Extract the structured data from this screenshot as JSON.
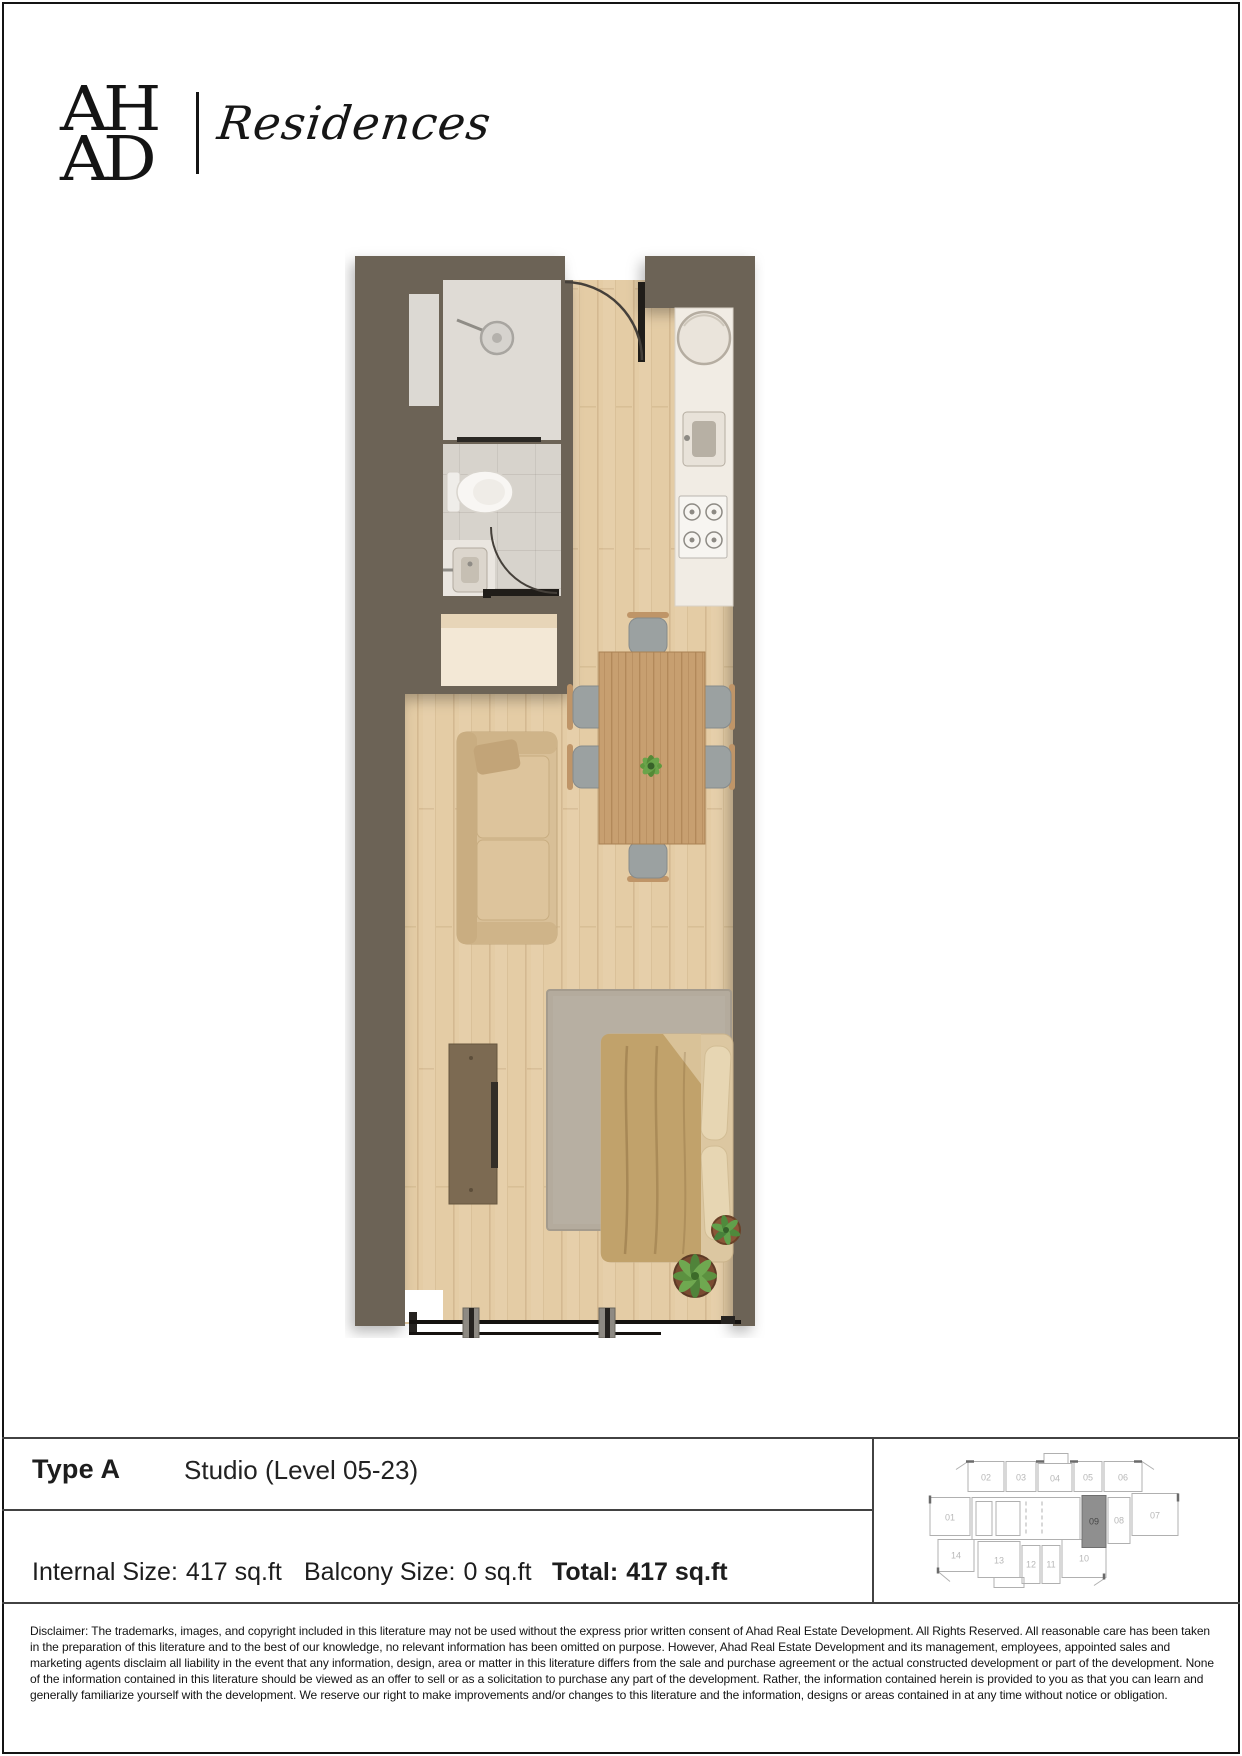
{
  "brand": {
    "logo_top": "AH",
    "logo_bottom": "AD",
    "wordmark": "Residences"
  },
  "unit": {
    "type_label": "Type A",
    "type_desc": "Studio (Level 05-23)",
    "internal_label": "Internal Size:",
    "internal_value": "417 sq.ft",
    "balcony_label": "Balcony Size:",
    "balcony_value": "0 sq.ft",
    "total_label": "Total:",
    "total_value": "417 sq.ft"
  },
  "key_plan": {
    "highlighted_unit": "09",
    "highlight_color": "#8f8f8f",
    "units": [
      "01",
      "02",
      "03",
      "04",
      "05",
      "06",
      "07",
      "08",
      "09",
      "10",
      "11",
      "12",
      "13",
      "14"
    ]
  },
  "floor_plan": {
    "colors": {
      "wall": "#6c6457",
      "wood_floor": "#e4cca5",
      "tile_floor": "#d7d3cc",
      "shower_floor": "#dfdbd5",
      "counter": "#f1ece4"
    },
    "features": [
      "entry-door",
      "shower",
      "toilet",
      "wash-basin",
      "storage-niche",
      "wardrobe",
      "refrigerator",
      "kitchen-sink",
      "gas-hob",
      "sofa",
      "tv-console",
      "dining-table",
      "dining-chairs",
      "double-bed",
      "rug",
      "plants",
      "window-wall"
    ]
  },
  "disclaimer": "Disclaimer: The trademarks, images, and copyright included in this literature may not be used without the express prior written consent of Ahad Real Estate Development. All Rights Reserved. All reasonable care has been taken in the preparation of this literature and to the best of our knowledge, no relevant information has been omitted on purpose. However, Ahad Real Estate Development and its management, employees, appointed sales and marketing agents disclaim all liability in the event that any information, design, area or matter in this literature differs from the sale and purchase agreement or the actual constructed development or part of the development. None of the information contained in this literature should be viewed as an offer to sell or as a solicitation to purchase any part of the development. Rather, the information contained herein is provided to you as that you can learn and generally familiarize yourself with the development. We reserve our right to make improvements and/or changes to this literature and the information, designs or areas contained in at any time without notice or obligation."
}
